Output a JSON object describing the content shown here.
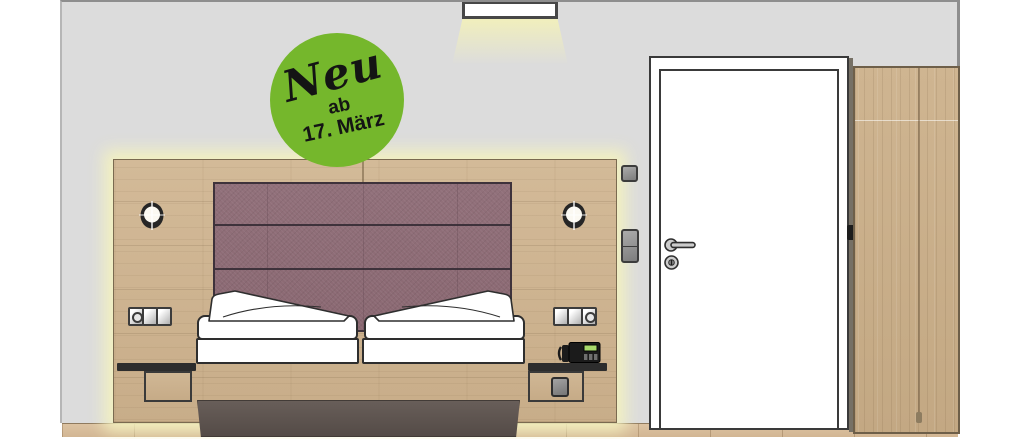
{
  "badge": {
    "line1": "Neu",
    "line2": "ab",
    "line3": "17. März"
  },
  "colors": {
    "badge_green": "#75b72c",
    "badge_text": "#141414",
    "wall_gray": "#dcdcdc",
    "panel_wood": "#cdb392",
    "wardrobe_wood": "#c9af8d",
    "floor_wood": "#d7bd9c",
    "headboard_mauve": "#8e6c76",
    "led_glow_yellow": "#f3f1bf",
    "bed_frame_dark": "#5d5450",
    "bed_linen_white": "#ffffff",
    "door_white": "#ffffff",
    "outline_dark": "#3a3a3a",
    "phone_display_green": "#a8d96b"
  }
}
